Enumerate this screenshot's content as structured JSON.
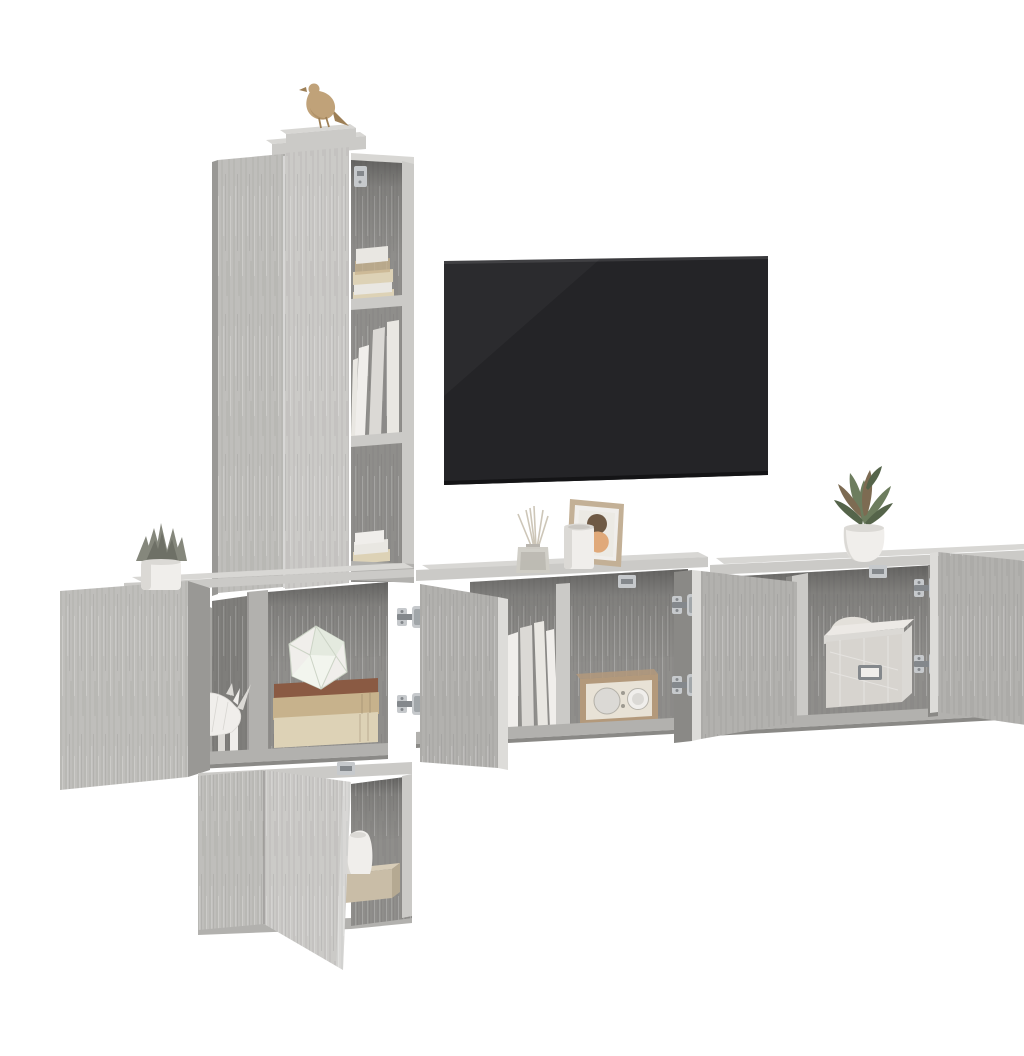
{
  "meta": {
    "type": "product-photo",
    "description": "Studio product photograph on a pure white background: a 5-piece grey sonoma oak wall-mounted TV media wall with several doors standing open (chrome concealed hinges visible), styled with books and ornaments, and a black flat-screen TV mounted on the wall.",
    "background": "#ffffff"
  },
  "scene": {
    "label": "Grey sonoma oak 5-piece wall-hung TV cabinet set with open doors, decor accessories and wall-mounted TV",
    "items": [
      {
        "name": "tall-cabinet",
        "description": "Tall wall-hung cabinet with two grey doors and an open side shelf column holding folded textiles and books"
      },
      {
        "name": "gold-bird-figurine",
        "description": "Small gold bird ornament standing on top of the tall cabinet"
      },
      {
        "name": "tv",
        "description": "Black flat-screen TV mounted on the white wall"
      },
      {
        "name": "left-wall-cabinet",
        "description": "Square wall cabinet with door swung open, containing a white origami rhino figurine and a stack of books topped by a geometric ornament"
      },
      {
        "name": "succulent-plant",
        "description": "Grey-green artificial succulent in a white pot on the left cabinet"
      },
      {
        "name": "bottom-wall-cabinet",
        "description": "Lower wall cabinet with an angled open door revealing a white jug on a wooden box"
      },
      {
        "name": "center-wall-cabinet",
        "description": "Wide wall-hung TV bench with both doors open showing white binders and a vintage radio"
      },
      {
        "name": "reed-diffuser",
        "description": "Glass reed diffuser with fanned sticks on the center cabinet top"
      },
      {
        "name": "white-vase",
        "description": "White cylindrical vase on the center cabinet top"
      },
      {
        "name": "picture-frame",
        "description": "Wood picture frame with abstract art: dark circle over an orange shape"
      },
      {
        "name": "vintage-radio",
        "description": "Retro radio with wooden case, cream face, speaker and dial"
      },
      {
        "name": "right-wall-cabinet",
        "description": "Wall cabinet with open doors showing a folded cushion and a quilted storage box with metal label holder"
      },
      {
        "name": "potted-plant",
        "description": "Green leafy plant in a round white pot on the right cabinet"
      },
      {
        "name": "chrome-hinges",
        "description": "Chrome concealed cup hinges on all open doors"
      },
      {
        "name": "wall-mount-brackets",
        "description": "Small chrome wall-mounting brackets inside the carcasses"
      }
    ]
  },
  "palette": {
    "page_bg": "#ffffff",
    "wood_front": "#bfbebb",
    "wood_front_light": "#cbcac7",
    "wood_mid": "#b2b1ae",
    "wood_dark": "#999895",
    "wood_darker": "#8a8986",
    "wood_top": "#d8d7d4",
    "wood_edge": "#dddcd9",
    "interior": "#8f8e8b",
    "interior_dark": "#7f7e7b",
    "tv_screen": "#242427",
    "tv_screen_edge": "#141416",
    "chrome": "#c6c9cc",
    "chrome_dark": "#84888c",
    "gold": "#c0a279",
    "gold_dark": "#9d7f56",
    "white_decor": "#f0eeeb",
    "white_decor_shade": "#dbd9d5",
    "book_cream": "#ddd2b6",
    "book_tan": "#c7b28c",
    "book_brown": "#8a5a43",
    "paper_white": "#e9e7e2",
    "radio_wood": "#b3997b",
    "radio_face": "#e8e2d6",
    "plant_green": "#6d7d5e",
    "plant_green_dark": "#55644a",
    "plant_accent": "#7d6b52",
    "succulent": "#85877c",
    "succulent_dark": "#6e7066",
    "fabric_box": "#d7d4cf",
    "fabric_box_lid": "#ece9e5",
    "cushion": "#e3e0da",
    "frame_wood": "#c3b096",
    "art_circle": "#6f5a45",
    "art_blob": "#e0a97a"
  }
}
